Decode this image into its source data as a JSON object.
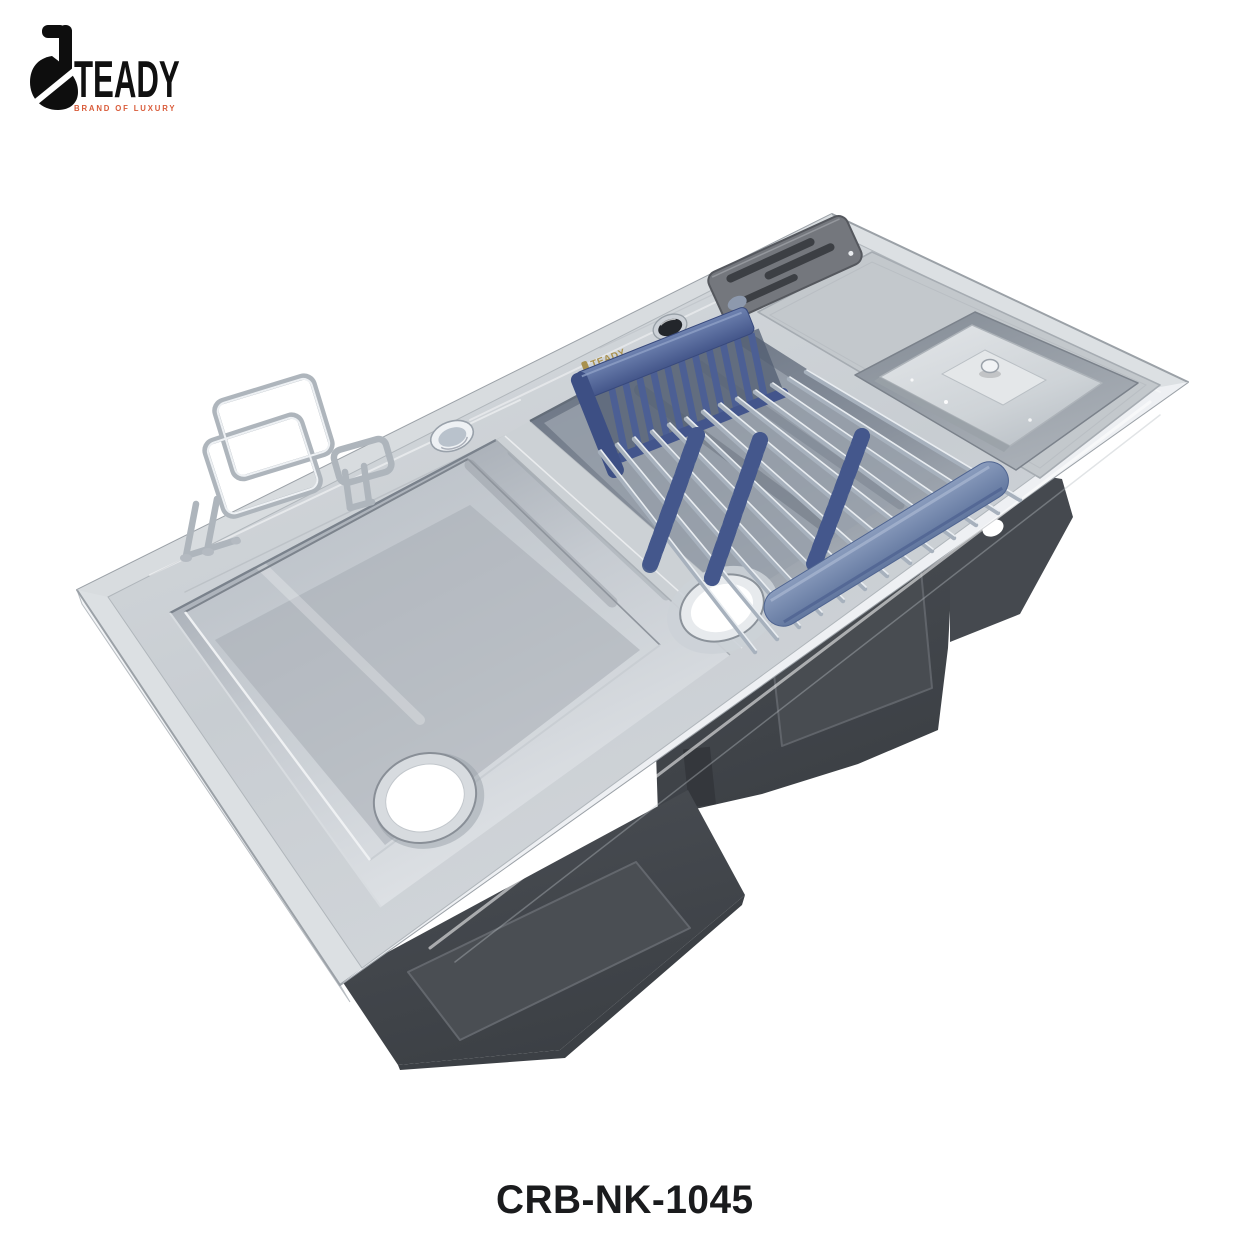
{
  "brand": {
    "name": "TEADY",
    "tagline": "BRAND OF LUXURY"
  },
  "product": {
    "code": "CRB-NK-1045",
    "engraving": "TEADY"
  },
  "colors": {
    "background": "#ffffff",
    "steel_light": "#e9ecee",
    "steel_mid": "#c9ced3",
    "steel_dark": "#8d949d",
    "undermount_gray": "#43474c",
    "rack_blue": "#5d72a1",
    "rack_blue_dark": "#42548a",
    "chrome_rod": "#aeb8c4",
    "logo_black": "#111111",
    "tagline_orange": "#d95b39",
    "code_text": "#1a1b1d",
    "engraving_gold": "#a9914f"
  }
}
